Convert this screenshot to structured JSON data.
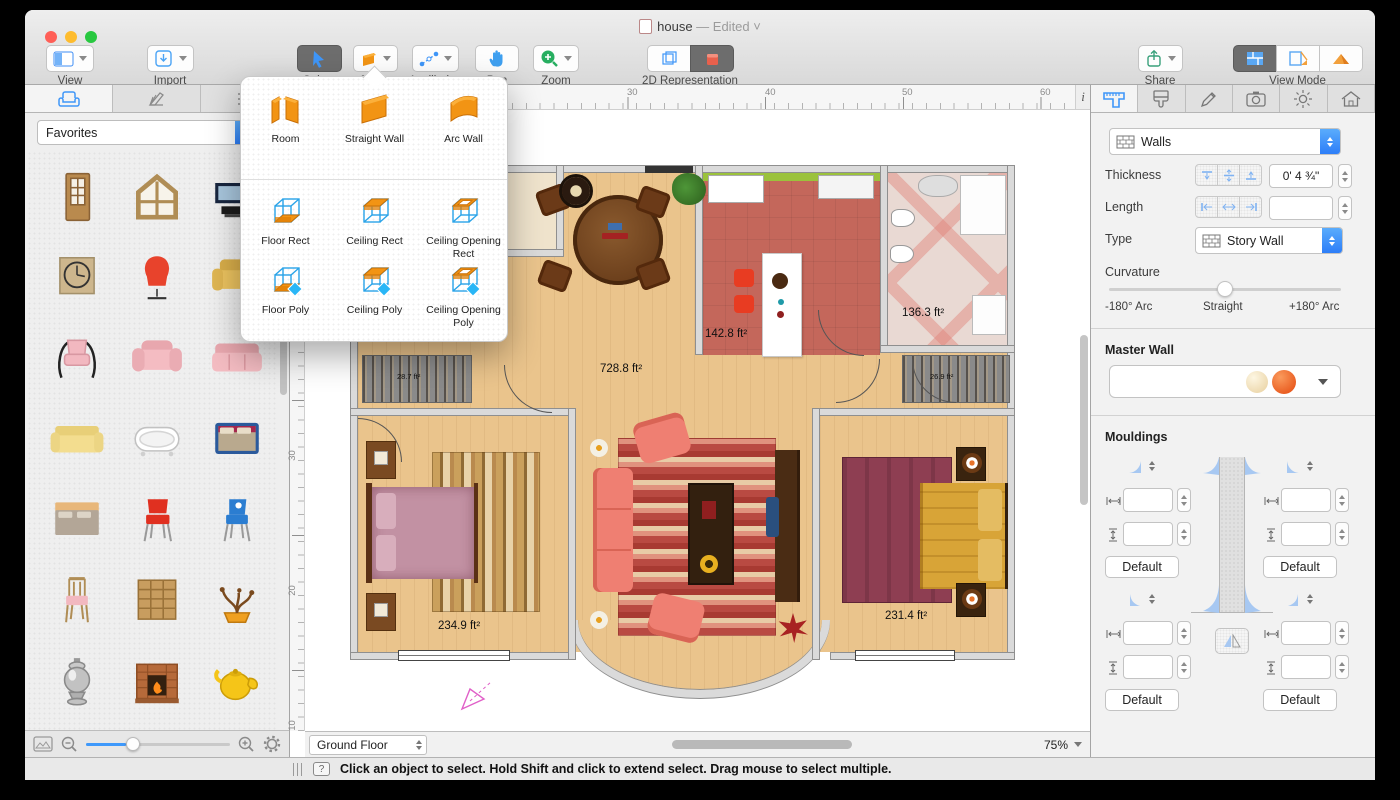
{
  "window": {
    "title": "house",
    "edited_suffix": "— Edited"
  },
  "toolbar": {
    "view": "View",
    "import": "Import",
    "select": "Select",
    "tools": "Tools",
    "auxiliaries": "Auxiliaries",
    "pan": "Pan",
    "zoom": "Zoom",
    "representation_2d": "2D Representation",
    "share": "Share",
    "view_mode": "View Mode"
  },
  "tools_popup": {
    "items": [
      {
        "label": "Room",
        "icon": "room"
      },
      {
        "label": "Straight Wall",
        "icon": "straight-wall"
      },
      {
        "label": "Arc Wall",
        "icon": "arc-wall"
      },
      {
        "label": "Floor Rect",
        "icon": "floor-rect"
      },
      {
        "label": "Ceiling Rect",
        "icon": "ceiling-rect"
      },
      {
        "label": "Ceiling Opening Rect",
        "icon": "ceiling-opening-rect"
      },
      {
        "label": "Floor Poly",
        "icon": "floor-poly"
      },
      {
        "label": "Ceiling Poly",
        "icon": "ceiling-poly"
      },
      {
        "label": "Ceiling Opening Poly",
        "icon": "ceiling-opening-poly"
      }
    ]
  },
  "sidebar": {
    "tabs": [
      "furniture",
      "materials",
      "library-list"
    ],
    "category": "Favorites",
    "items": [
      "door",
      "window",
      "tv-stand",
      "wall-clock",
      "egg-chair",
      "armchair-yellow",
      "chair-pink-metal",
      "armchair-pink",
      "sofa-pink",
      "sofa-yellow",
      "bathtub",
      "bed-double",
      "bed-gray",
      "chair-red",
      "chair-blue",
      "chair-wooden",
      "shelf-unit",
      "bonsai",
      "samovar",
      "fireplace",
      "teapot",
      "pot-blue",
      "floor-lamp",
      "table-lamp"
    ]
  },
  "canvas": {
    "ruler_top": [
      "30",
      "40",
      "50",
      "60"
    ],
    "ruler_left": [
      "30",
      "20",
      "10"
    ],
    "info_button": "i",
    "floor_selector": "Ground Floor",
    "zoom_level": "75%",
    "rooms": {
      "living": "728.8 ft²",
      "kitchen": "142.8 ft²",
      "bathroom": "136.3 ft²",
      "bedroom_left": "234.9 ft²",
      "bedroom_right": "231.4 ft²",
      "closet_left": "28.7 ft²",
      "closet_right": "26.9 ft²"
    }
  },
  "status_bar": {
    "message": "Click an object to select. Hold Shift and click to extend select. Drag mouse to select multiple."
  },
  "inspector": {
    "tabs": [
      "walls",
      "materials",
      "edit",
      "camera",
      "light",
      "building"
    ],
    "object_type": "Walls",
    "thickness_label": "Thickness",
    "thickness_value": "0' 4 ¾\"",
    "length_label": "Length",
    "length_value": "",
    "type_label": "Type",
    "type_value": "Story Wall",
    "curvature_label": "Curvature",
    "curvature_min": "-180° Arc",
    "curvature_mid": "Straight",
    "curvature_max": "+180° Arc",
    "master_wall_label": "Master Wall",
    "mouldings_label": "Mouldings",
    "default_button": "Default"
  }
}
